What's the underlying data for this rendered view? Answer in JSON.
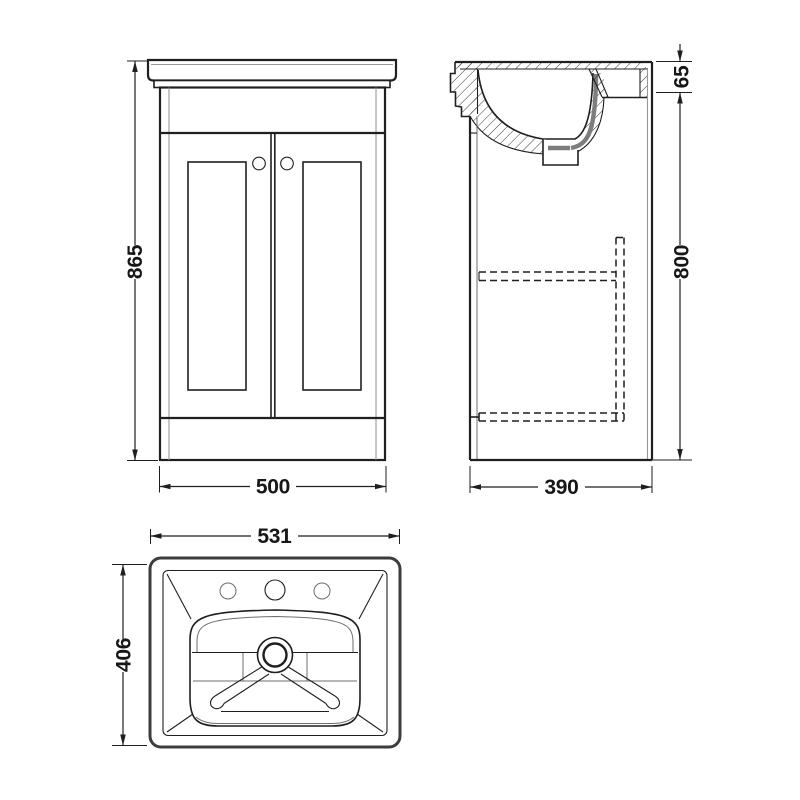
{
  "drawing": {
    "background_color": "#ffffff",
    "line_color": "#1f1f1f",
    "thin_line_color": "#979797",
    "pipe_gray_color": "#7d7d7d",
    "views": {
      "front_view": {
        "dimensions": {
          "overall_height": "865",
          "overall_width": "500"
        }
      },
      "side_view": {
        "dimensions": {
          "basin_rim_height": "65",
          "cabinet_height": "800",
          "cabinet_depth": "390"
        }
      },
      "plan_view": {
        "dimensions": {
          "basin_width": "531",
          "basin_depth": "406"
        }
      }
    }
  }
}
